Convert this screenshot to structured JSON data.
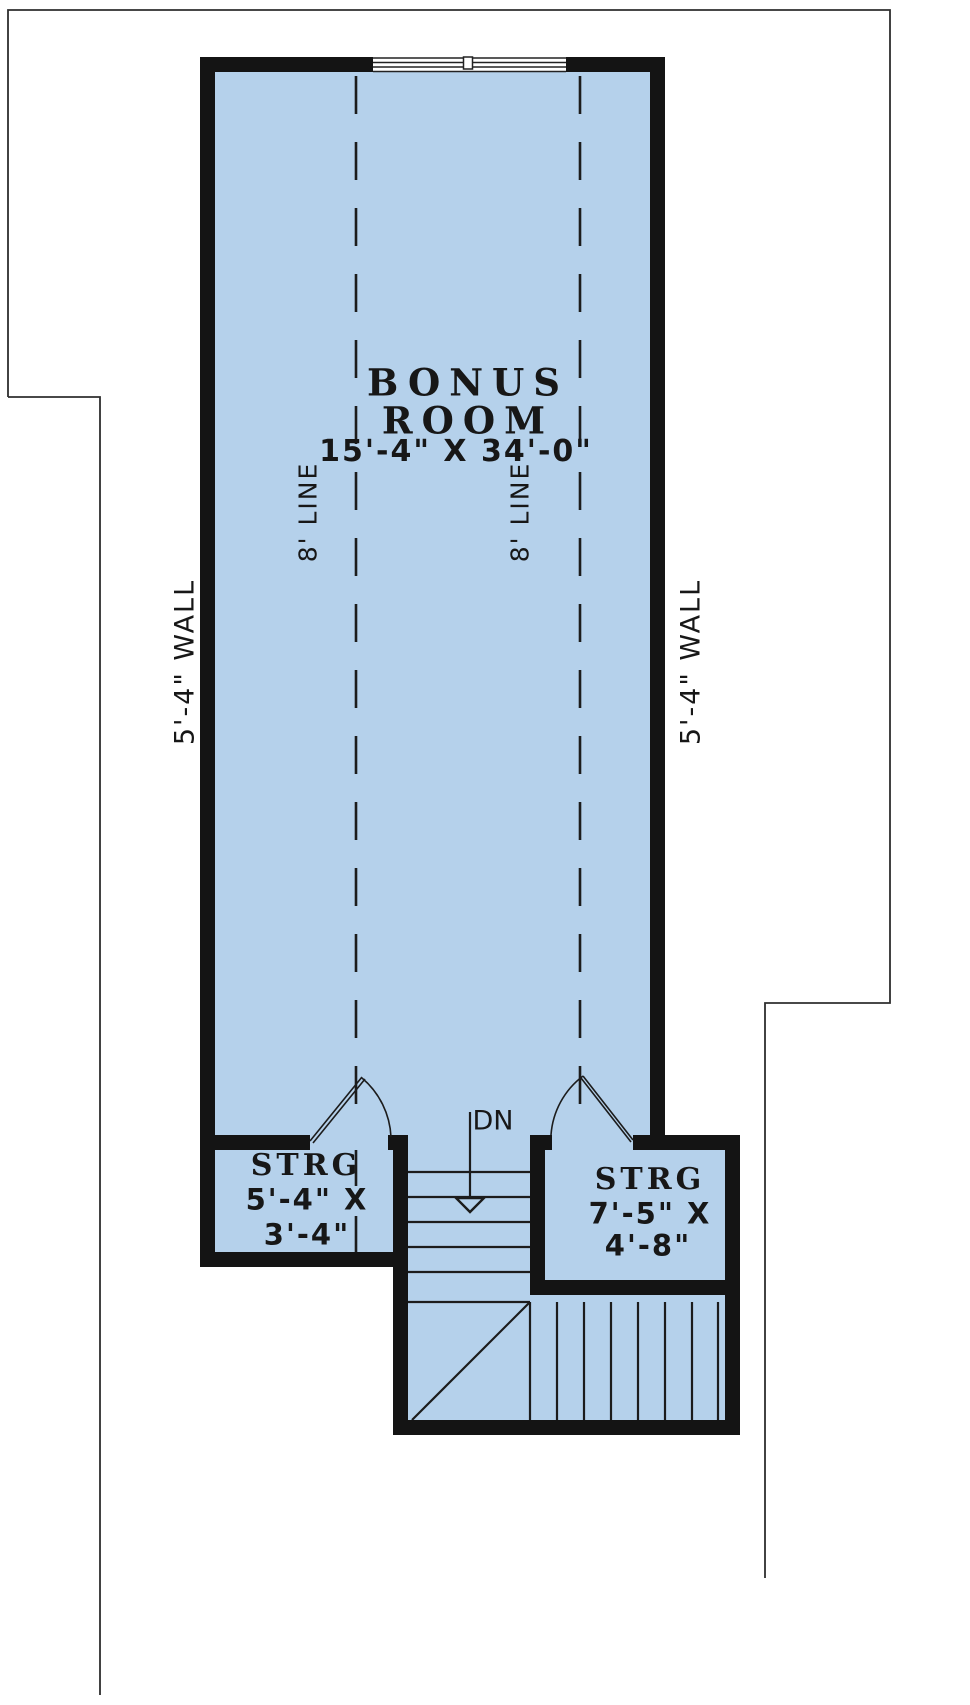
{
  "floor_plan": {
    "bonus_room": {
      "label_line1": "BONUS",
      "label_line2": "ROOM",
      "dimensions": "15'-4\" X 34'-0\""
    },
    "ceiling_lines": {
      "left_label": "8' LINE",
      "right_label": "8' LINE"
    },
    "wall_labels": {
      "left": "5'-4\" WALL",
      "right": "5'-4\" WALL"
    },
    "storage_left": {
      "label": "STRG",
      "dimensions_line1": "5'-4\" X",
      "dimensions_line2": "3'-4\""
    },
    "storage_right": {
      "label": "STRG",
      "dimensions_line1": "7'-5\" X",
      "dimensions_line2": "4'-8\""
    },
    "stairs": {
      "direction_label": "DN"
    },
    "colors": {
      "floor_fill": "#b5d1eb",
      "wall": "#141414",
      "line": "#1c1c1c",
      "background": "#ffffff"
    }
  }
}
